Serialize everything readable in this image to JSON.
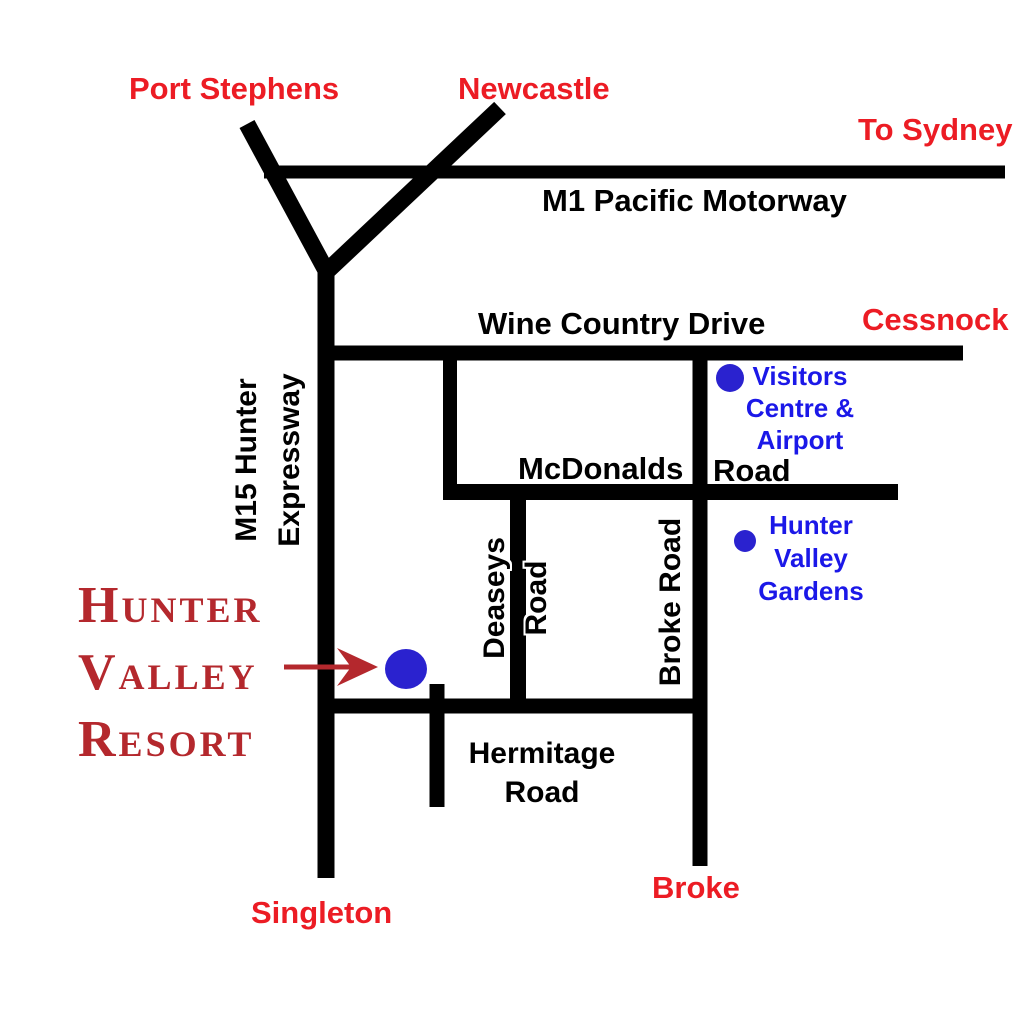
{
  "colors": {
    "road": "#000000",
    "city-red": "#ec1c24",
    "poi-blue": "#1b18e8",
    "dot-blue": "#2a22cf",
    "resort-red": "#b4282d"
  },
  "cities": {
    "port_stephens": "Port Stephens",
    "newcastle": "Newcastle",
    "to_sydney": "To Sydney",
    "cessnock": "Cessnock",
    "singleton": "Singleton",
    "broke": "Broke"
  },
  "roads": {
    "m1": "M1 Pacific Motorway",
    "wine_country_drive": "Wine Country Drive",
    "m15": {
      "lines": [
        "M15 Hunter",
        "Expressway"
      ]
    },
    "mcdonalds": "McDonalds",
    "mcdonalds_suffix": "Road",
    "deaseys": {
      "lines": [
        "Deaseys",
        "Road"
      ]
    },
    "broke_road": "Broke Road",
    "hermitage": {
      "lines": [
        "Hermitage",
        "Road"
      ]
    }
  },
  "pois": {
    "visitors_centre": {
      "lines": [
        "Visitors",
        "Centre &",
        "Airport"
      ]
    },
    "hunter_valley_gardens": {
      "lines": [
        "Hunter",
        "Valley",
        "Gardens"
      ]
    },
    "hunter_valley_resort": {
      "lines": [
        "Hunter",
        "Valley",
        "Resort"
      ]
    }
  }
}
